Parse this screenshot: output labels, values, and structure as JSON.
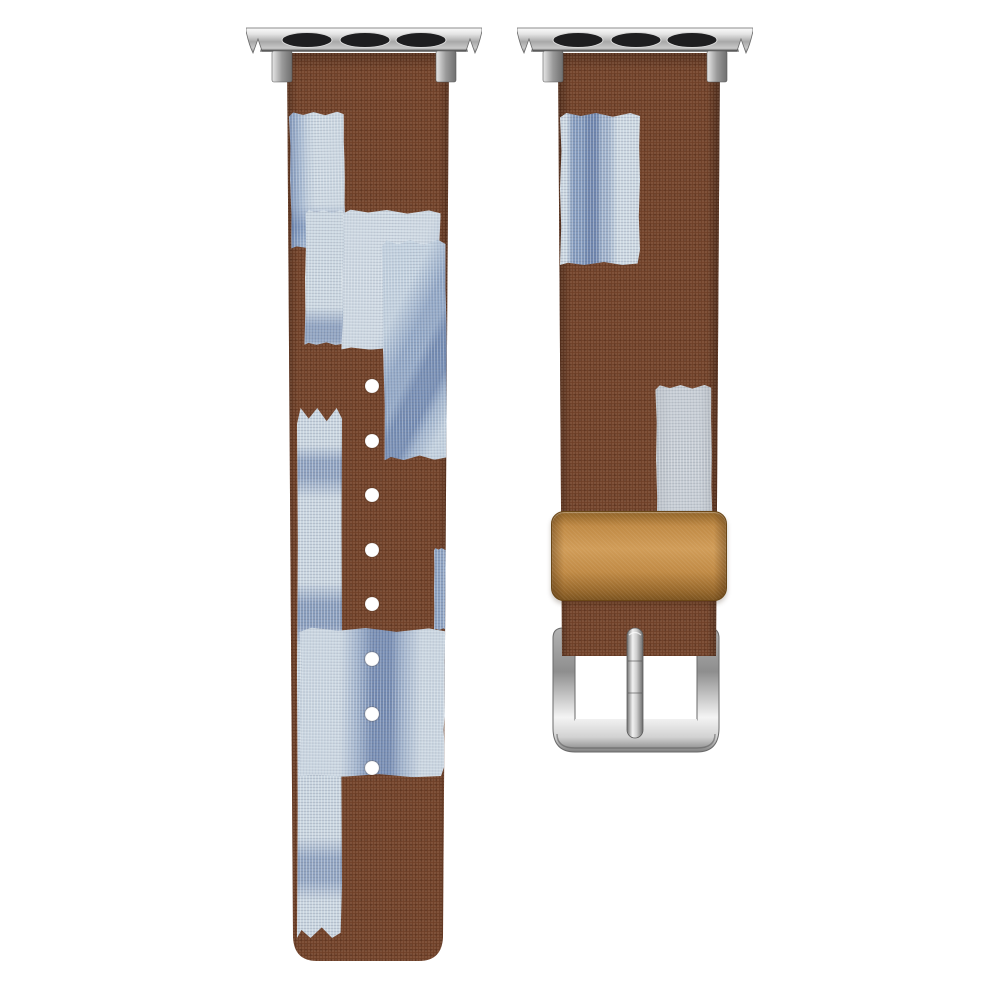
{
  "scene": {
    "kind": "product-photo",
    "title": "Patchwork fabric Apple Watch replacement band, two straps on white background",
    "background_color": "#ffffff",
    "materials": "brown suede-like fabric strap with indigo-dyed canvas patches, silver metal hardware, tan leather keeper"
  },
  "colors": {
    "background": "#ffffff",
    "strap_brown": "#6e3f27",
    "patch_light_blue": "#cfdae4",
    "patch_gray": "#c5ccd4",
    "indigo_strong": "#31508c",
    "indigo_mid": "#4969a0",
    "keeper_tan": "#c08a45",
    "metal_light": "#f4f4f4",
    "metal_dark": "#8a8a8a",
    "slot_black": "#1e1e20",
    "hole_white": "#ffffff"
  },
  "components": {
    "left_strap": {
      "role": "long strap with adjustment holes",
      "hole_count": 8,
      "adapter_slots": 3
    },
    "right_strap": {
      "role": "buckle strap",
      "adapter_slots": 3,
      "keeper": "tan leather loop",
      "buckle": "silver square buckle with prong"
    }
  },
  "artwork": {
    "left": {
      "adapter": {
        "x": 246,
        "y": 27,
        "w": 236,
        "h": 56
      },
      "fabric": {
        "x": 284,
        "y": 53,
        "w": 168,
        "h": 911,
        "clip": "M 3 0 L 165 0 L 159 884 Q 158 908 135 908 L 33 908 Q 10 908 9 884 Z"
      },
      "patches": [
        {
          "name": "patch-upper-left",
          "variant": "v-edge-left",
          "x": 6,
          "y": 59,
          "w": 55,
          "h": 136,
          "rot": -1
        },
        {
          "name": "patch-left-column-top",
          "variant": "v-bands-h-a",
          "x": 21,
          "y": 157,
          "w": 40,
          "h": 135,
          "rot": 0.5
        },
        {
          "name": "patch-left-column",
          "variant": "v-bands-h",
          "x": 13,
          "y": 355,
          "w": 45,
          "h": 530,
          "rot": 0
        },
        {
          "name": "patch-wide-upper",
          "variant": "v-plain-light",
          "x": 58,
          "y": 157,
          "w": 98,
          "h": 140,
          "rot": 0.6
        },
        {
          "name": "patch-right-streaked",
          "variant": "v-streaks-diag",
          "x": 99,
          "y": 187,
          "w": 64,
          "h": 220,
          "rot": -0.8
        },
        {
          "name": "patch-right-sliver",
          "variant": "v-streaks-v-soft",
          "x": 150,
          "y": 495,
          "w": 17,
          "h": 82,
          "rot": 0
        },
        {
          "name": "patch-big-middle",
          "variant": "v-band-v",
          "x": 15,
          "y": 575,
          "w": 147,
          "h": 149,
          "rot": 0.4
        }
      ],
      "holes": {
        "x": 88,
        "start_y": 333,
        "step": 54.6,
        "count": 8,
        "r": 7
      }
    },
    "right": {
      "adapter": {
        "x": 517,
        "y": 27,
        "w": 236,
        "h": 56
      },
      "fabric": {
        "x": 558,
        "y": 53,
        "w": 162,
        "h": 603,
        "clip": "M 0 0 L 162 0 L 158 603 L 4 603 Z"
      },
      "patches": [
        {
          "name": "patch-upper-streaked",
          "variant": "v-streaks-v",
          "x": 2,
          "y": 60,
          "w": 80,
          "h": 152,
          "rot": 0
        },
        {
          "name": "patch-lower-gray",
          "variant": "v-plain-gray",
          "x": 98,
          "y": 332,
          "w": 56,
          "h": 150,
          "rot": -0.5
        }
      ],
      "keeper": {
        "x": 551,
        "y": 511,
        "w": 174,
        "h": 88
      },
      "buckle": {
        "x": 551,
        "y": 624,
        "w": 170,
        "h": 132
      },
      "prong": {
        "x": 625,
        "y": 627,
        "w": 20,
        "h": 112
      }
    }
  }
}
